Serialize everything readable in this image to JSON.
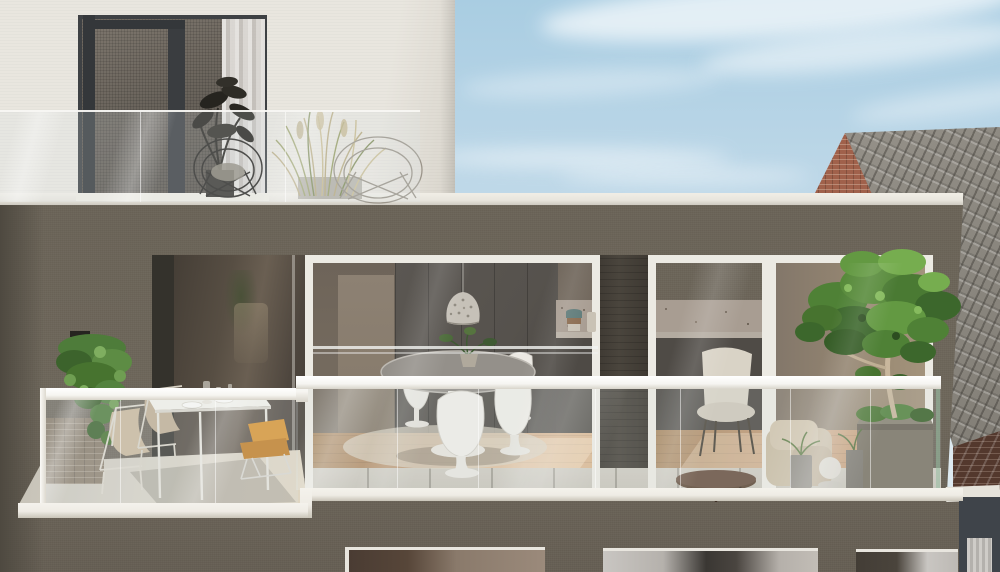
{
  "scene": {
    "title": "Architectural 3D render — modern apartment building facade with terraces",
    "description": "Photorealistic exterior rendering of a contemporary apartment building. A dark taupe stucco facade holds a wide terrace with frameless glass balustrades and white handrails. Behind floor-to-ceiling glazing a dining room with a white tulip table and chairs, a perforated pendant lamp and a dark kitchen is visible; a second glazed bay shows a living room with an armchair, round coffee table and sofa. The left terrace has a white outdoor dining table, two beige sling chairs, a lounger with mustard cushions and an ivy plant hanging from the wall. On the right terrace a large green tree stands in a square planter beside small pots. Above, a white penthouse level with a glass balcony holds ornamental grasses, a dark potted plant and two wire chairs. A neighboring brick-gabled house with a grey tiled roof stands to the right under a pale blue sky with wispy clouds.",
    "regions": {
      "sky": "blue sky with wispy clouds",
      "upper_building": "white penthouse level with balcony",
      "neighbor_house": "brick gable and tiled roof of adjacent house",
      "main_facade": "dark taupe stucco facade",
      "center_interior": "dining room with tulip table, pendant lamp and dark kitchen",
      "right_interior": "living room with armchair, coffee table and sofa",
      "left_terrace": "outdoor dining furniture and hanging ivy",
      "right_terrace": "large tree in square planter with small pots",
      "lower_floor": "lower level windows with curtains"
    }
  },
  "palette": {
    "sky-top": "#a9cde2",
    "sky-mid": "#c6dcea",
    "sky-low": "#dde9f0",
    "white-wall": "#e9e6df",
    "white-wall-shade": "#d9d5cc",
    "coping": "#e8e5dd",
    "facade": "#6b6458",
    "facade-left": "#4e4940",
    "pillar": "#4a453d",
    "rail": "#f6f5f1",
    "fascia": "#efece5",
    "roof-tile": "#97938b",
    "brick-gable": "#a0614b",
    "brick-dark": "#53382d",
    "ledge": "#e6e3db",
    "corner-dark": "#3f444a",
    "int-wall": "#7b7164",
    "cabinet": "#56524d",
    "counter": "#a89d92",
    "wood": "#c39c79",
    "wood-lit": "#d3ac87",
    "tulip-white": "#f0eee9",
    "table-gray": "#94908a",
    "rug": "#d8d1c2",
    "lamp": "#c6c1b8",
    "green-dark": "#3c672c",
    "green-mid": "#578a3a",
    "green-light": "#74a84e",
    "grass": "#b3a67e",
    "ivy": "#4e7c3a",
    "cushion-orange": "#d8922f",
    "cushion-orange-dark": "#c07c22",
    "chair-beige": "#c9b89c",
    "terrace-floor": "#d7d2c6",
    "paver": "#c9c5bb"
  }
}
